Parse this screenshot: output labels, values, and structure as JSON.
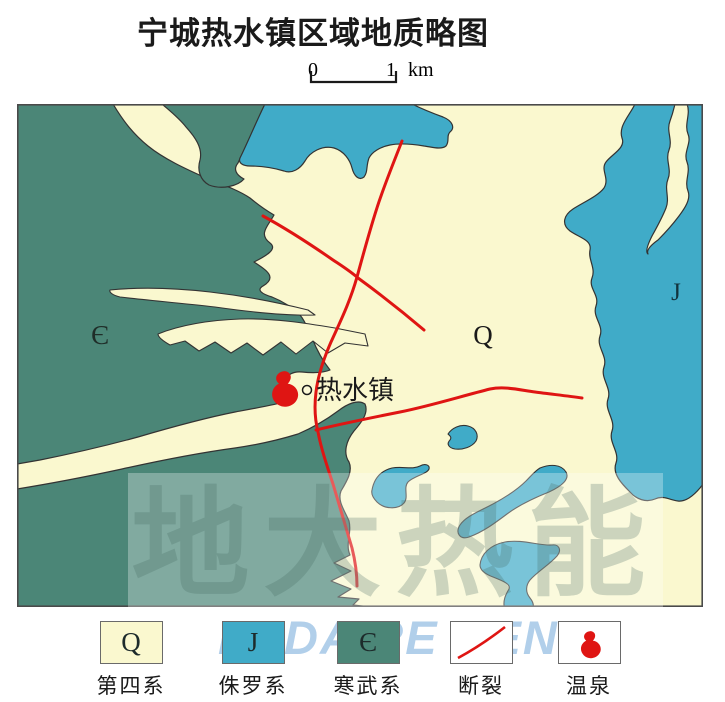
{
  "title": "宁城热水镇区域地质略图",
  "scale_bar": {
    "zero": "0",
    "one": "1",
    "unit": "km"
  },
  "map": {
    "labels": {
      "cambrian": "Є",
      "quaternary": "Q",
      "jurassic": "J",
      "town": "热水镇"
    }
  },
  "legend": {
    "items": [
      {
        "symbol": "Q",
        "label": "第四系",
        "icon": "quaternary-swatch"
      },
      {
        "symbol": "J",
        "label": "侏罗系",
        "icon": "jurassic-swatch"
      },
      {
        "symbol": "Є",
        "label": "寒武系",
        "icon": "cambrian-swatch"
      },
      {
        "symbol": "",
        "label": "断裂",
        "icon": "fault-line"
      },
      {
        "symbol": "",
        "label": "温泉",
        "icon": "hot-spring"
      }
    ]
  },
  "watermark": {
    "hanzi": "地大热能",
    "latin": "DI DA RE NENG"
  },
  "colors": {
    "quaternary": "#FAF8CF",
    "jurassic": "#40ABC8",
    "cambrian": "#4B8677",
    "fault_red": "#DF1513",
    "outline": "#333333",
    "map_border": "#4A4A4A",
    "text": "#1A1A1A",
    "watermark_latin": "#7EB2DC"
  }
}
